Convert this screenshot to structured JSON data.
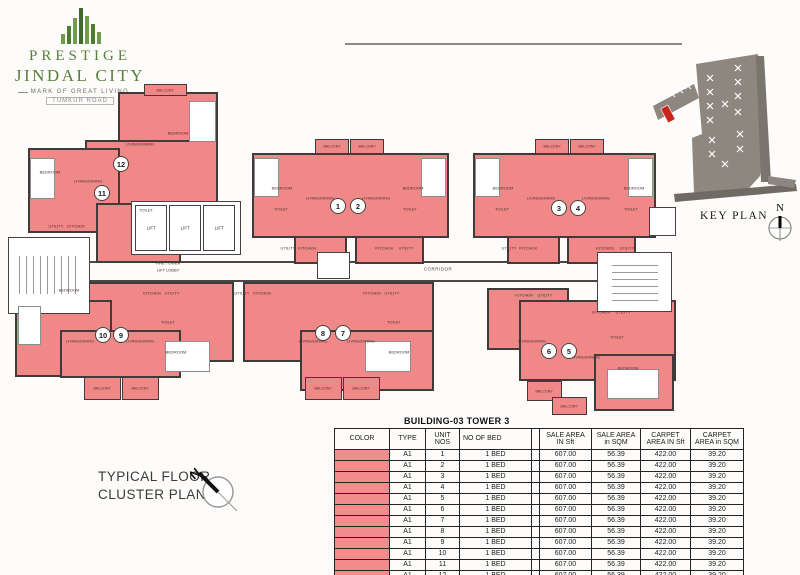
{
  "logo": {
    "line1": "PRESTIGE",
    "line2": "JINDAL CITY",
    "tagline": "MARK OF GREAT LIVING",
    "subtitle": "TUMKUR ROAD"
  },
  "key_plan": {
    "label": "KEY PLAN",
    "north": "N"
  },
  "plan": {
    "caption_line1": "TYPICAL FLOOR",
    "caption_line2": "CLUSTER PLAN",
    "corridor": "CORRIDOR",
    "fire_tower_line1": "FIRE TOWER",
    "fire_tower_line2": "LIFT LOBBY",
    "lift": "LIFT",
    "north": "N",
    "room_labels": {
      "bedroom": "BEDROOM",
      "living": "LIVING/DINING",
      "kitchen": "KITCHEN",
      "utility": "UTILITY",
      "toilet": "TOILET",
      "balcony": "BALCONY"
    },
    "units": [
      {
        "no": "1",
        "x": 338,
        "y": 206
      },
      {
        "no": "2",
        "x": 358,
        "y": 206
      },
      {
        "no": "3",
        "x": 559,
        "y": 208
      },
      {
        "no": "4",
        "x": 578,
        "y": 208
      },
      {
        "no": "5",
        "x": 569,
        "y": 351
      },
      {
        "no": "6",
        "x": 549,
        "y": 351
      },
      {
        "no": "7",
        "x": 343,
        "y": 333
      },
      {
        "no": "8",
        "x": 323,
        "y": 333
      },
      {
        "no": "9",
        "x": 121,
        "y": 335
      },
      {
        "no": "10",
        "x": 103,
        "y": 335
      },
      {
        "no": "11",
        "x": 102,
        "y": 193
      },
      {
        "no": "12",
        "x": 121,
        "y": 164
      }
    ]
  },
  "table": {
    "title": "BUILDING-03  TOWER 3",
    "headers": [
      "COLOR",
      "TYPE",
      "UNIT NOS",
      "NO OF BED",
      "",
      "SALE AREA\nIN Sft",
      "SALE AREA\nin SQM",
      "CARPET\nAREA IN Sft",
      "CARPET\nAREA in SQM"
    ],
    "rows": [
      {
        "type": "A1",
        "unit": "1",
        "bed": "1 BED",
        "sale_sft": "607.00",
        "sale_sqm": "56.39",
        "carpet_sft": "422.00",
        "carpet_sqm": "39.20"
      },
      {
        "type": "A1",
        "unit": "2",
        "bed": "1 BED",
        "sale_sft": "607.00",
        "sale_sqm": "56.39",
        "carpet_sft": "422.00",
        "carpet_sqm": "39.20"
      },
      {
        "type": "A1",
        "unit": "3",
        "bed": "1 BED",
        "sale_sft": "607.00",
        "sale_sqm": "56.39",
        "carpet_sft": "422.00",
        "carpet_sqm": "39.20"
      },
      {
        "type": "A1",
        "unit": "4",
        "bed": "1 BED",
        "sale_sft": "607.00",
        "sale_sqm": "56.39",
        "carpet_sft": "422.00",
        "carpet_sqm": "39.20"
      },
      {
        "type": "A1",
        "unit": "5",
        "bed": "1 BED",
        "sale_sft": "607.00",
        "sale_sqm": "56.39",
        "carpet_sft": "422.00",
        "carpet_sqm": "39.20"
      },
      {
        "type": "A1",
        "unit": "6",
        "bed": "1 BED",
        "sale_sft": "607.00",
        "sale_sqm": "56.39",
        "carpet_sft": "422.00",
        "carpet_sqm": "39.20"
      },
      {
        "type": "A1",
        "unit": "7",
        "bed": "1 BED",
        "sale_sft": "607.00",
        "sale_sqm": "56.39",
        "carpet_sft": "422.00",
        "carpet_sqm": "39.20"
      },
      {
        "type": "A1",
        "unit": "8",
        "bed": "1 BED",
        "sale_sft": "607.00",
        "sale_sqm": "56.39",
        "carpet_sft": "422.00",
        "carpet_sqm": "39.20"
      },
      {
        "type": "A1",
        "unit": "9",
        "bed": "1 BED",
        "sale_sft": "607.00",
        "sale_sqm": "56.39",
        "carpet_sft": "422.00",
        "carpet_sqm": "39.20"
      },
      {
        "type": "A1",
        "unit": "10",
        "bed": "1 BED",
        "sale_sft": "607.00",
        "sale_sqm": "56.39",
        "carpet_sft": "422.00",
        "carpet_sqm": "39.20"
      },
      {
        "type": "A1",
        "unit": "11",
        "bed": "1 BED",
        "sale_sft": "607.00",
        "sale_sqm": "56.39",
        "carpet_sft": "422.00",
        "carpet_sqm": "39.20"
      },
      {
        "type": "A1",
        "unit": "12",
        "bed": "1 BED",
        "sale_sft": "607.00",
        "sale_sqm": "56.39",
        "carpet_sft": "422.00",
        "carpet_sqm": "39.20"
      }
    ]
  },
  "colors": {
    "unit_fill": "#f08888",
    "wall": "#403b3a",
    "table_swatch": "#f28b8b",
    "logo_green": "#587f3b",
    "keyplan_gray": "#8d8780",
    "keyplan_highlight_red": "#c9251c"
  }
}
